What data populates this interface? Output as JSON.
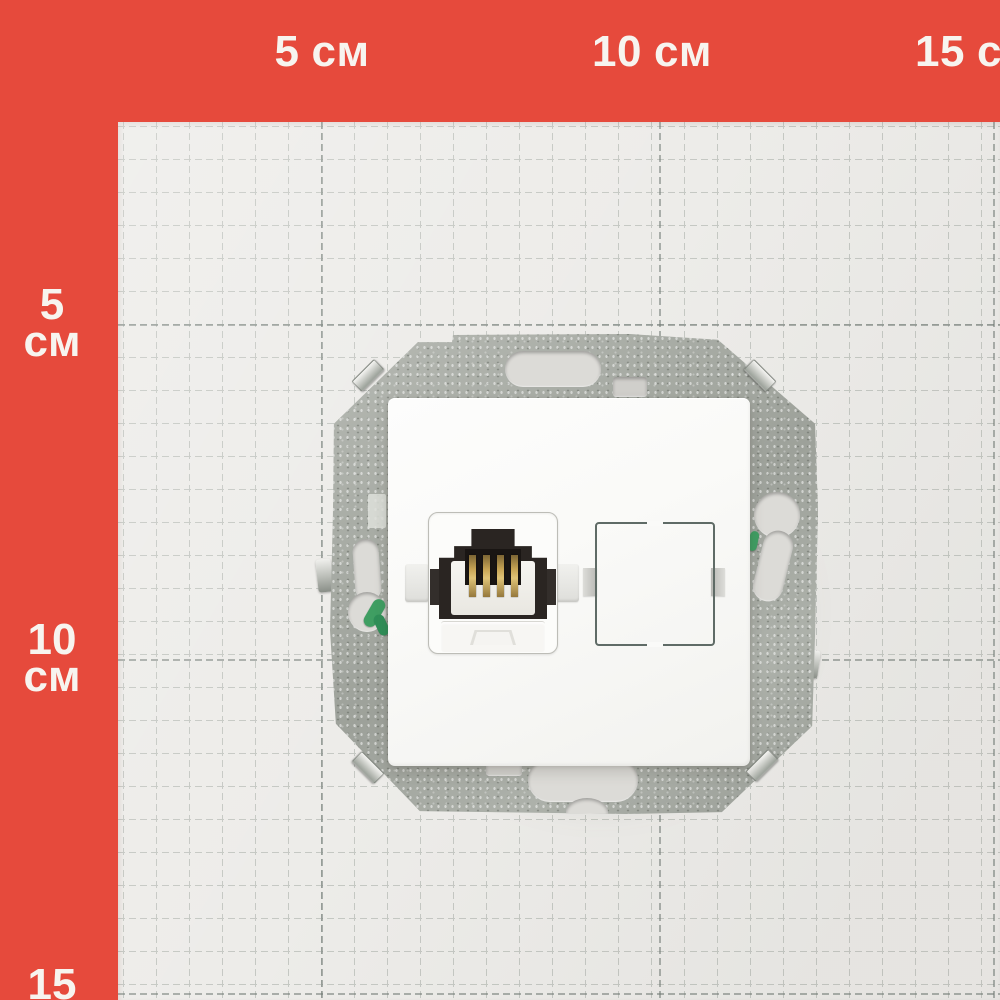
{
  "ruler": {
    "top_labels": [
      {
        "value": "5",
        "unit": "см"
      },
      {
        "value": "10",
        "unit": "см"
      },
      {
        "value": "15",
        "unit": "см"
      }
    ],
    "left_labels": [
      {
        "value": "5",
        "unit": "см"
      },
      {
        "value": "10",
        "unit": "см"
      },
      {
        "value": "15",
        "unit": "см"
      }
    ]
  },
  "colors": {
    "frame_red": "#e64a3c",
    "paper": "#edece9",
    "grid_line": "#c5c8c3",
    "grid_major_line": "#707a74",
    "metal_frame": "#a8aca5",
    "faceplate_white": "#fafaf8",
    "jack_opening_dark": "#2a2522",
    "contact_pins_gold": "#c9a656",
    "wire_green": "#3f9e62"
  }
}
